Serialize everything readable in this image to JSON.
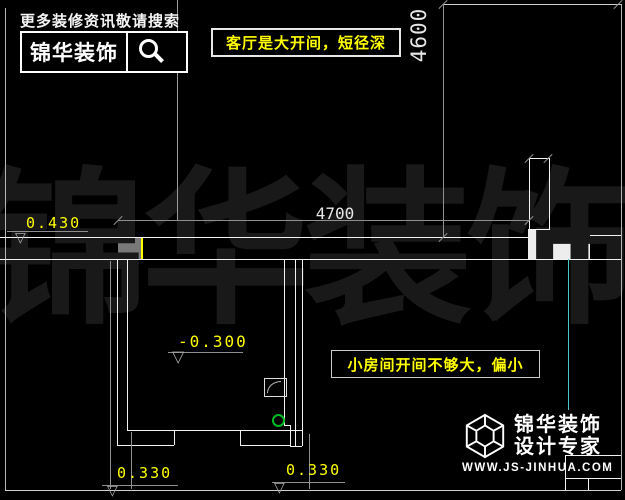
{
  "header": {
    "tagline": "更多装修资讯敬请搜索",
    "brand_name": "锦华装饰"
  },
  "annotations": {
    "living_room_note": "客厅是大开间，短径深",
    "small_room_note": "小房间开间不够大，偏小"
  },
  "dimensions": {
    "height_dim": "4600",
    "width_dim": "4700"
  },
  "elevations": {
    "upper": "0.430",
    "room": "-0.300",
    "bottom_left": "0.330",
    "bottom_right": "0.330",
    "triangle_glyph": "▽"
  },
  "watermark_text": "锦华装饰",
  "footer": {
    "brand_line1": "锦华装饰",
    "brand_line2": "设计专家",
    "website": "WWW.JS-JINHUA.COM"
  },
  "colors": {
    "background": "#000000",
    "annotation_yellow": "#ffff00",
    "wall_white": "#f2f2f2",
    "dim_gray": "#8f8f8f",
    "highlight_fill": "#787878",
    "green_marker": "#00bb22",
    "cyan_line": "#49c8c8",
    "watermark_gray": "#191919"
  }
}
